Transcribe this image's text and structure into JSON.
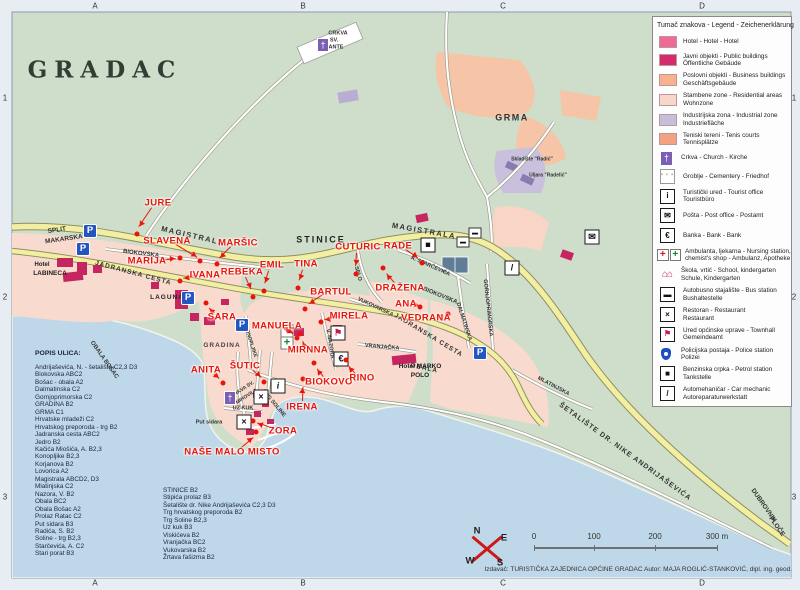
{
  "title": {
    "map_title": "GRADAC"
  },
  "grid": {
    "cols": [
      "A",
      "B",
      "C",
      "D"
    ],
    "rows": [
      "1",
      "2",
      "3"
    ]
  },
  "legend": {
    "title": "Tumač znakova - Legend - Zeichenerklärung",
    "items": [
      {
        "icon": "hotel-swatch",
        "type": "swatch",
        "color": "#ef6a97",
        "lines": [
          "Hotel - Hotel - Hotel"
        ]
      },
      {
        "icon": "public-buildings-swatch",
        "type": "swatch",
        "color": "#d62a6e",
        "lines": [
          "Javni objekti - Public buildings",
          "Öffentliche Gebäude"
        ]
      },
      {
        "icon": "business-buildings-swatch",
        "type": "swatch",
        "color": "#f9b28e",
        "lines": [
          "Poslovni objekti - Business buildings",
          "Geschäftsgebäude"
        ]
      },
      {
        "icon": "residential-zone-swatch",
        "type": "swatch",
        "color": "#f9d6ca",
        "lines": [
          "Stambene zone - Residential areas",
          "Wohnzone"
        ]
      },
      {
        "icon": "industrial-zone-swatch",
        "type": "swatch industrial",
        "color": "#c6bedb",
        "lines": [
          "Industrijska zona - Industrial zone",
          "Industriefläche"
        ]
      },
      {
        "icon": "tennis-courts-swatch",
        "type": "swatch",
        "color": "#f2a183",
        "lines": [
          "Teniski tereni - Tenis courts",
          "Tennisplätze"
        ]
      },
      {
        "icon": "church-icon",
        "type": "church-lg",
        "glyph": "†",
        "lines": [
          "Crkva - Church - Kirche"
        ]
      },
      {
        "icon": "cemetery-icon",
        "type": "boxed cemetery",
        "glyph": "' ' '",
        "lines": [
          "Groblje - Cementery - Friedhof"
        ]
      },
      {
        "icon": "tourist-office-icon",
        "type": "boxed",
        "glyph": "i",
        "lines": [
          "Turistički ured - Tourist office",
          "Touristbüro"
        ]
      },
      {
        "icon": "post-office-icon",
        "type": "boxed",
        "glyph": "✉",
        "lines": [
          "Pošta - Post office - Postamt"
        ]
      },
      {
        "icon": "bank-icon",
        "type": "boxed",
        "glyph": "€",
        "lines": [
          "Banka - Bank - Bank"
        ]
      },
      {
        "icon": "ambulance-icon",
        "type": "dbl",
        "lines": [
          "Ambulanta, ljekarna - Nursing station,",
          "chemist's shop - Ambulanz, Apotheke"
        ]
      },
      {
        "icon": "school-icon",
        "type": "plainglyph",
        "glyph": "⌂⌂",
        "lines": [
          "Škola, vrtić - School, kindergarten",
          "Schule, Kindergarten"
        ]
      },
      {
        "icon": "bus-station-icon",
        "type": "boxed",
        "glyph": "▬",
        "lines": [
          "Autobusno stajalište - Bus station",
          "Bushaltestelle"
        ]
      },
      {
        "icon": "restaurant-icon",
        "type": "boxed",
        "glyph": "×",
        "lines": [
          "Restoran - Restaurant",
          "Restaurant"
        ]
      },
      {
        "icon": "townhall-icon",
        "type": "boxed flagglyph",
        "glyph": "⚑",
        "lines": [
          "Ured općinske uprave - Townhall",
          "Gemeindeamt"
        ]
      },
      {
        "icon": "police-icon",
        "type": "shield",
        "glyph": "",
        "lines": [
          "Policijska postaja - Police station",
          "Polizei"
        ]
      },
      {
        "icon": "petrol-icon",
        "type": "boxed",
        "glyph": "■",
        "lines": [
          "Benzinska crpka - Petrol station",
          "Tankstelle"
        ]
      },
      {
        "icon": "car-mechanic-icon",
        "type": "boxed",
        "glyph": "/",
        "lines": [
          "Automehaničar - Car mechanic",
          "Autoreparaturwerkstatt"
        ]
      }
    ]
  },
  "street_index": {
    "title": "POPIS ULICA:",
    "entries": [
      "Andrijaševića, N. - šetalište  C2,3 D3",
      "Biokovska  ABC2",
      "Bošac - obala  A2",
      "Dalmatinska  C2",
      "Gornjoprimorska  C2",
      "GRADINA  B2",
      "GRMA  C1",
      "Hrvatske mladeži  C2",
      "Hrvatskog preporoda - trg  B2",
      "Jadranska cesta  ABC2",
      "Jedro  B2",
      "Kačića Miošića, A.  B2,3",
      "Konopljike  B2,3",
      "Korjanova  B2",
      "Lovorica  A2",
      "Magistrala  ABCD2, D3",
      "Mlatinjska  C2",
      "Nazora, V.  B2",
      "Obala  BC2",
      "Obala Bošac  A2",
      "Prolaz Ratac  C2",
      "Put sidara  B3",
      "Radića, S.  B2",
      "Soline - trg  B2,3",
      "Starčevića, A.  C2",
      "Stari porat  B3"
    ]
  },
  "street_index_2": {
    "entries": [
      "STINICE  B2",
      "Stipića prolaz  B3",
      "Šetalište dr. Nike Andrijaševića  C2,3 D3",
      "Trg hrvatskog preporoda  B2",
      "Trg Soline  B2,3",
      "Uz kuk  B3",
      "Viskićeva  B2",
      "Vranjačka  BC2",
      "Vukovarska  B2",
      "Žrtava fašizma  B2"
    ]
  },
  "map": {
    "red_labels": [
      {
        "text": "JURE",
        "x": 158,
        "y": 203,
        "ax": 137,
        "ay": 234
      },
      {
        "text": "SLAVENA",
        "x": 167,
        "y": 241,
        "ax": 200,
        "ay": 261
      },
      {
        "text": "MARIJA",
        "x": 147,
        "y": 261,
        "ax": 180,
        "ay": 258
      },
      {
        "text": "MARŠIC",
        "x": 238,
        "y": 243,
        "ax": 217,
        "ay": 264
      },
      {
        "text": "IVANA",
        "x": 205,
        "y": 275,
        "ax": 180,
        "ay": 281
      },
      {
        "text": "REBEKA",
        "x": 242,
        "y": 272,
        "ax": 253,
        "ay": 297
      },
      {
        "text": "EMIL",
        "x": 272,
        "y": 265,
        "ax": 264,
        "ay": 291
      },
      {
        "text": "TINA",
        "x": 306,
        "y": 264,
        "ax": 298,
        "ay": 288
      },
      {
        "text": "CUTURIC",
        "x": 358,
        "y": 247,
        "ax": 356,
        "ay": 274
      },
      {
        "text": "RADE",
        "x": 398,
        "y": 246,
        "ax": 422,
        "ay": 263
      },
      {
        "text": "DRAŽENA",
        "x": 400,
        "y": 288,
        "ax": 383,
        "ay": 268
      },
      {
        "text": "ANA",
        "x": 406,
        "y": 304,
        "ax": 420,
        "ay": 307
      },
      {
        "text": "VEDRANA",
        "x": 426,
        "y": 318,
        "ax": 448,
        "ay": 314
      },
      {
        "text": "BARTUL",
        "x": 331,
        "y": 292,
        "ax": 305,
        "ay": 309
      },
      {
        "text": "MIRELA",
        "x": 349,
        "y": 316,
        "ax": 321,
        "ay": 322
      },
      {
        "text": "MANUELA",
        "x": 277,
        "y": 326,
        "ax": 297,
        "ay": 338
      },
      {
        "text": "SARA",
        "x": 222,
        "y": 317,
        "ax": 206,
        "ay": 303
      },
      {
        "text": "MIRNNA",
        "x": 308,
        "y": 350,
        "ax": 300,
        "ay": 334
      },
      {
        "text": "ŠUTIC",
        "x": 245,
        "y": 366,
        "ax": 264,
        "ay": 382
      },
      {
        "text": "ANITA",
        "x": 206,
        "y": 370,
        "ax": 223,
        "ay": 383
      },
      {
        "text": "BIOKOVO",
        "x": 329,
        "y": 382,
        "ax": 314,
        "ay": 363
      },
      {
        "text": "RINO",
        "x": 362,
        "y": 378,
        "ax": 346,
        "ay": 360
      },
      {
        "text": "IRENA",
        "x": 302,
        "y": 407,
        "ax": 303,
        "ay": 379
      },
      {
        "text": "ZORA",
        "x": 283,
        "y": 431,
        "ax": 253,
        "ay": 421
      },
      {
        "text": "NAŠE MALO MISTO",
        "x": 232,
        "y": 452,
        "ax": 256,
        "ay": 432
      }
    ],
    "street_labels": [
      {
        "text": "MAGISTRALA",
        "x": 193,
        "y": 236,
        "r": 13,
        "s": 7.5,
        "sp": 1.5
      },
      {
        "text": "MAGISTRALA",
        "x": 424,
        "y": 231,
        "r": 10,
        "s": 7.5,
        "sp": 1.5
      },
      {
        "text": "BIOKOVSKA",
        "x": 141,
        "y": 254,
        "r": 7,
        "s": 6
      },
      {
        "text": "BIOKOVSKA",
        "x": 440,
        "y": 296,
        "r": 22,
        "s": 6
      },
      {
        "text": "JADRANSKA CESTA",
        "x": 133,
        "y": 274,
        "r": 15,
        "s": 6.5,
        "sp": 1
      },
      {
        "text": "JADRANSKA CESTA",
        "x": 428,
        "y": 336,
        "r": 31,
        "s": 6.5,
        "sp": 1
      },
      {
        "text": "OBALA BOŠAC",
        "x": 104,
        "y": 360,
        "r": 55,
        "s": 6
      },
      {
        "text": "OBALA",
        "x": 424,
        "y": 369,
        "r": 12,
        "s": 6.5,
        "sp": 1
      },
      {
        "text": "SELO",
        "x": 357,
        "y": 274,
        "r": 74,
        "s": 5.5
      },
      {
        "text": "A. STARČEVIĆA",
        "x": 430,
        "y": 267,
        "r": 24,
        "s": 5.5
      },
      {
        "text": "DALMATINSKA",
        "x": 463,
        "y": 322,
        "r": 72,
        "s": 5.5
      },
      {
        "text": "GORNJOPRIMORSKA",
        "x": 487,
        "y": 308,
        "r": 84,
        "s": 5.5
      },
      {
        "text": "MLATINJSKA",
        "x": 553,
        "y": 387,
        "r": 28,
        "s": 5.5
      },
      {
        "text": "V. NAZORA",
        "x": 329,
        "y": 344,
        "r": 80,
        "s": 5.5
      },
      {
        "text": "VUKOVARSKA",
        "x": 375,
        "y": 308,
        "r": 25,
        "s": 5.5
      },
      {
        "text": "VRANJAČKA",
        "x": 382,
        "y": 348,
        "r": 5,
        "s": 5.5
      },
      {
        "text": "KONOPLJIKE",
        "x": 250,
        "y": 342,
        "r": 72,
        "s": 5
      },
      {
        "text": "TRG SOLINE",
        "x": 273,
        "y": 404,
        "r": 50,
        "s": 5.5
      },
      {
        "text": "UZ KUK",
        "x": 243,
        "y": 409,
        "r": 0,
        "s": 5.5
      },
      {
        "text": "Put sidara",
        "x": 209,
        "y": 423,
        "r": 0,
        "s": 5.5
      },
      {
        "text": "ŠETALIŠTE DR. NIKE ANDRIJAŠEVIĆA",
        "x": 625,
        "y": 452,
        "r": 36,
        "s": 7,
        "sp": 1
      },
      {
        "text": "DUBROVNIK",
        "x": 763,
        "y": 506,
        "r": 55,
        "s": 6.5
      },
      {
        "text": "PLOČE",
        "x": 776,
        "y": 527,
        "r": 55,
        "s": 6.5
      }
    ],
    "place_labels": [
      {
        "text": "STINICE",
        "x": 321,
        "y": 240,
        "s": 9,
        "sp": 2,
        "c": "#222"
      },
      {
        "text": "GRMA",
        "x": 512,
        "y": 118,
        "s": 9,
        "sp": 1.5,
        "c": "#333"
      },
      {
        "text": "GRADINA",
        "x": 222,
        "y": 346,
        "s": 6.5,
        "sp": 1,
        "c": "#444"
      },
      {
        "text": "SPLIT",
        "x": 57,
        "y": 231,
        "s": 6.5,
        "c": "#333",
        "r": -8
      },
      {
        "text": "MAKARSKA",
        "x": 64,
        "y": 240,
        "s": 6.5,
        "c": "#333",
        "r": -8
      },
      {
        "text": "Hotel",
        "x": 42,
        "y": 265,
        "s": 6,
        "c": "#222"
      },
      {
        "text": "LABINECA",
        "x": 50,
        "y": 274,
        "s": 6.5,
        "c": "#222"
      },
      {
        "text": "LAGUNA",
        "x": 167,
        "y": 298,
        "s": 6.5,
        "sp": 1,
        "c": "#222"
      },
      {
        "text": "Hotel MARKO",
        "x": 420,
        "y": 367,
        "s": 6.5,
        "c": "#222"
      },
      {
        "text": "POLO",
        "x": 420,
        "y": 376,
        "s": 6.5,
        "c": "#222"
      },
      {
        "text": "CRKVA",
        "x": 338,
        "y": 34,
        "s": 5.5,
        "c": "#333"
      },
      {
        "text": "SV.",
        "x": 334,
        "y": 41,
        "s": 5.5,
        "c": "#333"
      },
      {
        "text": "ANTE",
        "x": 336,
        "y": 48,
        "s": 5.5,
        "c": "#333"
      },
      {
        "text": "CRKVA SV.",
        "x": 243,
        "y": 390,
        "s": 5,
        "c": "#333",
        "r": -33
      },
      {
        "text": "MIHOVILA",
        "x": 247,
        "y": 397,
        "s": 5,
        "c": "#333",
        "r": -33
      },
      {
        "text": "Skladište \"Radić\"",
        "x": 532,
        "y": 160,
        "s": 5,
        "c": "#333"
      },
      {
        "text": "Uljara \"Radelić\"",
        "x": 548,
        "y": 176,
        "s": 5,
        "c": "#333"
      }
    ],
    "icons": [
      {
        "icon": "parking-icon",
        "type": "parking",
        "glyph": "P",
        "x": 90,
        "y": 231
      },
      {
        "icon": "parking-icon",
        "type": "parking",
        "glyph": "P",
        "x": 83,
        "y": 249
      },
      {
        "icon": "parking-icon",
        "type": "parking",
        "glyph": "P",
        "x": 188,
        "y": 298
      },
      {
        "icon": "parking-icon",
        "type": "parking",
        "glyph": "P",
        "x": 242,
        "y": 325
      },
      {
        "icon": "parking-icon",
        "type": "parking",
        "glyph": "P",
        "x": 480,
        "y": 353
      },
      {
        "icon": "tourist-office-icon",
        "type": "box serifi",
        "glyph": "i",
        "x": 278,
        "y": 386
      },
      {
        "icon": "restaurant-icon",
        "type": "box",
        "glyph": "×",
        "x": 261,
        "y": 397
      },
      {
        "icon": "restaurant-icon",
        "type": "box",
        "glyph": "×",
        "x": 244,
        "y": 422
      },
      {
        "icon": "bank-icon",
        "type": "box",
        "glyph": "€",
        "x": 341,
        "y": 359
      },
      {
        "icon": "townhall-icon",
        "type": "box flagbox",
        "glyph": "⚑",
        "x": 338,
        "y": 333
      },
      {
        "icon": "ambulance-red-cross-icon",
        "type": "amb-red",
        "glyph": "+",
        "x": 287,
        "y": 331
      },
      {
        "icon": "ambulance-green-cross-icon",
        "type": "amb-green",
        "glyph": "+",
        "x": 287,
        "y": 343
      },
      {
        "icon": "petrol-icon",
        "type": "box",
        "glyph": "■",
        "x": 428,
        "y": 245
      },
      {
        "icon": "post-office-icon",
        "type": "box",
        "glyph": "✉",
        "x": 592,
        "y": 237
      },
      {
        "icon": "bus-station-icon",
        "type": "busbox",
        "glyph": "▬",
        "x": 463,
        "y": 242
      },
      {
        "icon": "bus-station-icon",
        "type": "busbox",
        "glyph": "▬",
        "x": 475,
        "y": 233
      },
      {
        "icon": "church-icon",
        "type": "church",
        "glyph": "†",
        "x": 230,
        "y": 398
      },
      {
        "icon": "church-icon",
        "type": "church",
        "glyph": "†",
        "x": 323,
        "y": 45
      },
      {
        "icon": "car-mechanic-icon",
        "type": "box",
        "glyph": "/",
        "x": 512,
        "y": 268
      }
    ]
  },
  "compass": {
    "n": "N",
    "e": "E",
    "w": "W",
    "s": "S"
  },
  "scale": {
    "ticks": [
      "0",
      "100",
      "200",
      "300 m"
    ]
  },
  "credit": "Izdavač: TURISTIČKA ZAJEDNICA OPĆINE GRADAC   Autor: MAJA ROGLIĆ-STANKOVIĆ, dipl. ing. geod."
}
